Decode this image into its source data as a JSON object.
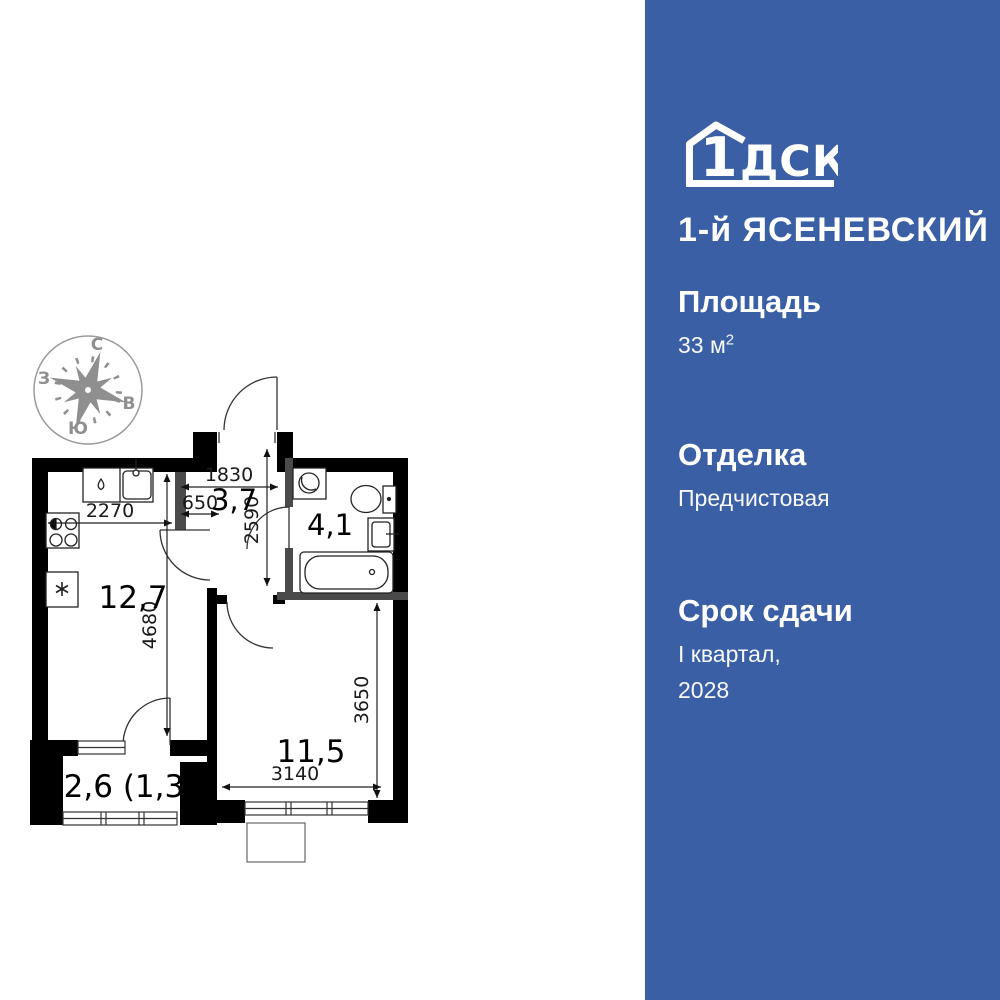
{
  "sidebar": {
    "bg_color": "#3a5fa5",
    "logo": {
      "brand_number": "1",
      "brand_letters": "ДСК",
      "project_name": "1-й ЯСЕНЕВСКИЙ"
    },
    "stats": {
      "area_label": "Площадь",
      "area_value": "33 м",
      "area_sup": "2",
      "finishing_label": "Отделка",
      "finishing_value": "Предчистовая",
      "deadline_label": "Срок сдачи",
      "deadline_line1": "I квартал,",
      "deadline_line2": "2028"
    }
  },
  "floorplan": {
    "colors": {
      "wall": "#000000",
      "partition": "#4a4a4a",
      "compass": "#8f8f8f"
    },
    "compass": {
      "n": "С",
      "e": "В",
      "s": "Ю",
      "w": "З"
    },
    "rooms": {
      "hallway": "3,7",
      "bathroom": "4,1",
      "kitchen_living": "12,7",
      "bedroom": "11,5",
      "balcony": "2,6 (1,3)"
    },
    "dimensions": {
      "kitchen_width": "2270",
      "kitchen_depth": "4680",
      "hallway_width": "1830",
      "hallway_recess": "650",
      "hallway_depth": "2590",
      "room_width": "3140",
      "room_depth": "3650"
    }
  }
}
